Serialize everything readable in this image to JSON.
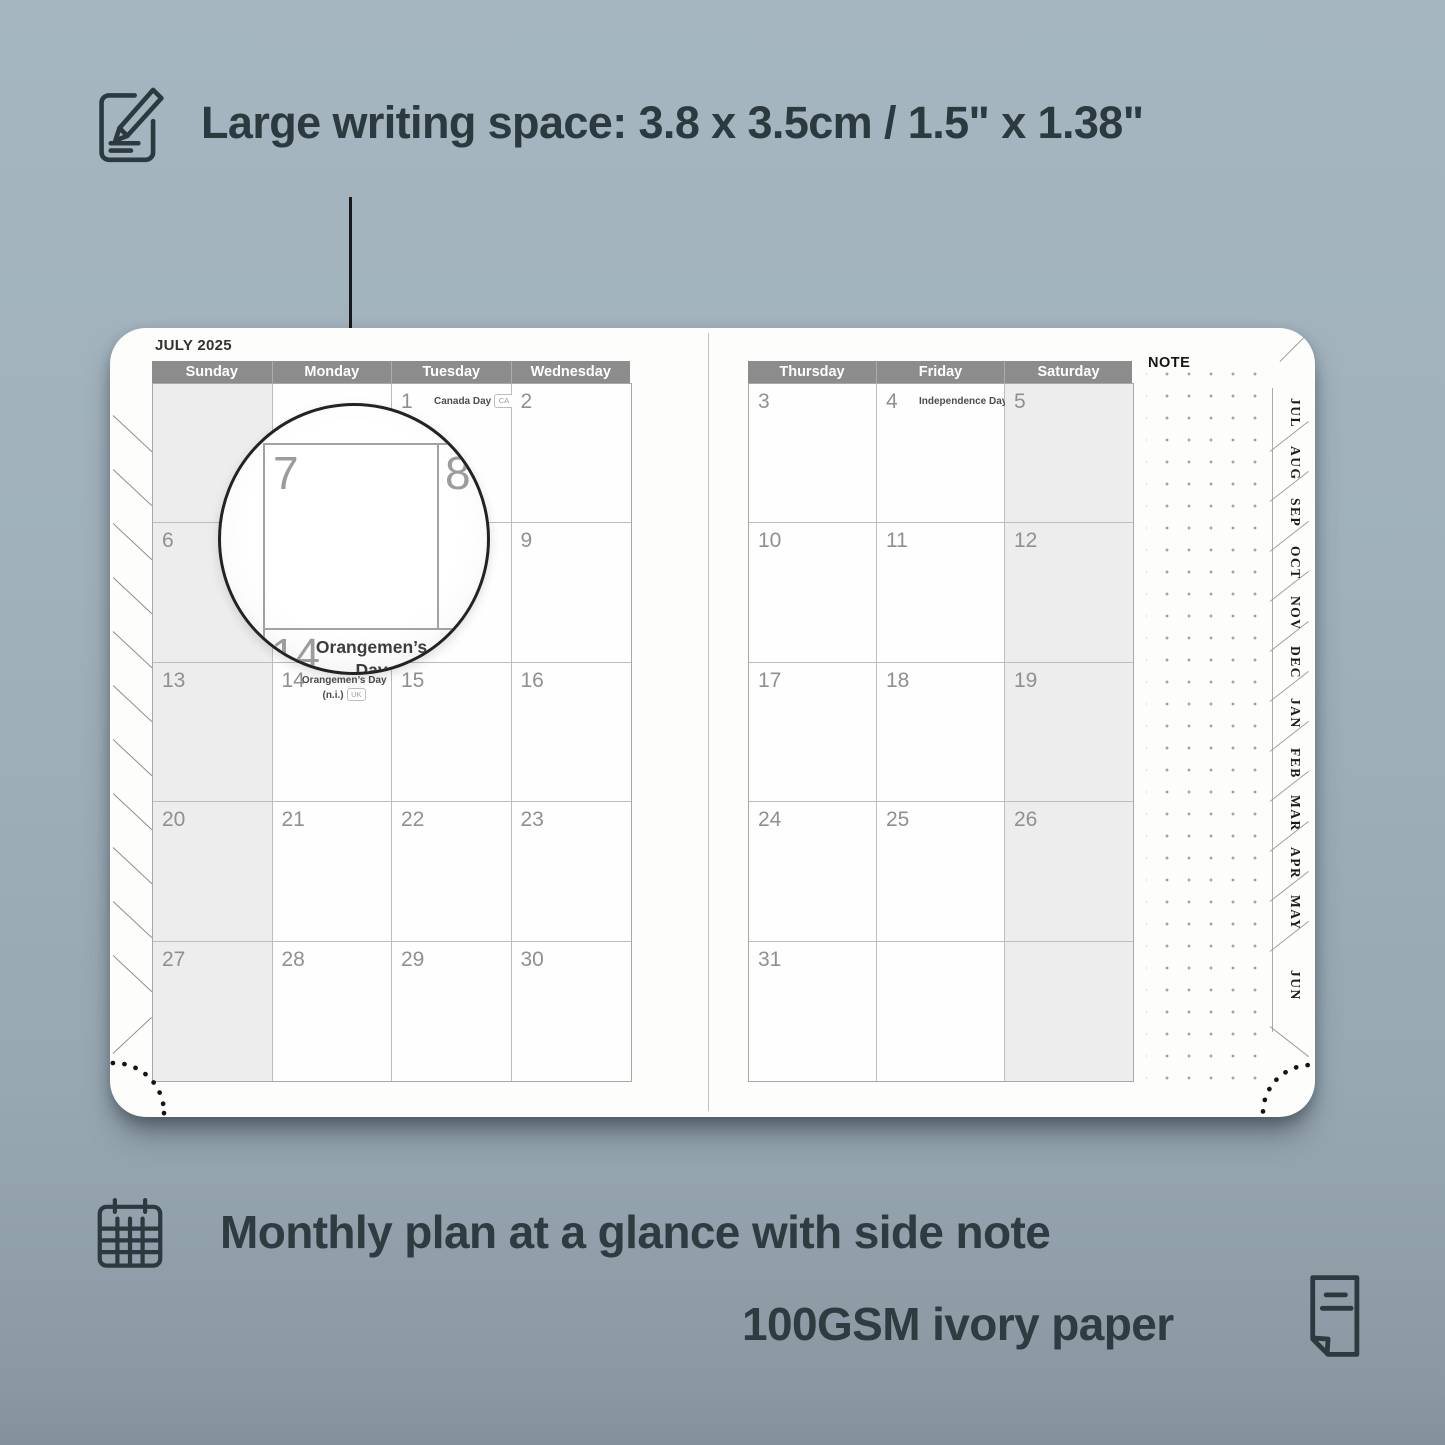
{
  "colors": {
    "background": "#9fb0ba",
    "header_bar": "#8c8c8c",
    "shaded_cell": "#ededed",
    "accent_text": "#2c3a40",
    "page": "#fdfdfc"
  },
  "headline": {
    "icon": "pencil-note-icon",
    "text": "Large writing space: 3.8 x 3.5cm / 1.5\" x 1.38\""
  },
  "planner": {
    "month_title": "JULY 2025",
    "note_label": "NOTE",
    "left_page": {
      "weekdays": [
        "Sunday",
        "Monday",
        "Tuesday",
        "Wednesday"
      ],
      "shaded_column": 0,
      "cells": [
        {
          "day": ""
        },
        {
          "day": ""
        },
        {
          "day": "1",
          "holiday": "Canada Day",
          "badge": "CA",
          "holiday_layout": "inline"
        },
        {
          "day": "2"
        },
        {
          "day": "6"
        },
        {
          "day": "7"
        },
        {
          "day": "8"
        },
        {
          "day": "9"
        },
        {
          "day": "13"
        },
        {
          "day": "14",
          "holiday": "Orangemen’s Day\n(n.i.)",
          "badge": "UK",
          "holiday_layout": "stacked"
        },
        {
          "day": "15"
        },
        {
          "day": "16"
        },
        {
          "day": "20"
        },
        {
          "day": "21"
        },
        {
          "day": "22"
        },
        {
          "day": "23"
        },
        {
          "day": "27"
        },
        {
          "day": "28"
        },
        {
          "day": "29"
        },
        {
          "day": "30"
        }
      ]
    },
    "right_page": {
      "weekdays": [
        "Thursday",
        "Friday",
        "Saturday"
      ],
      "shaded_column": 2,
      "cells": [
        {
          "day": "3"
        },
        {
          "day": "4",
          "holiday": "Independence Day",
          "badge": "US",
          "holiday_layout": "inline"
        },
        {
          "day": "5"
        },
        {
          "day": "10"
        },
        {
          "day": "11"
        },
        {
          "day": "12"
        },
        {
          "day": "17"
        },
        {
          "day": "18"
        },
        {
          "day": "19"
        },
        {
          "day": "24"
        },
        {
          "day": "25"
        },
        {
          "day": "26"
        },
        {
          "day": "31"
        },
        {
          "day": ""
        },
        {
          "day": ""
        }
      ]
    },
    "month_tabs": [
      "JUL",
      "AUG",
      "SEP",
      "OCT",
      "NOV",
      "DEC",
      "JAN",
      "FEB",
      "MAR",
      "APR",
      "MAY",
      "JUN"
    ]
  },
  "magnifier": {
    "large_day": "7",
    "adjacent_day": "8",
    "bottom_day": "14",
    "holiday_line1": "Orangemen’s Day",
    "holiday_line2": "(n.i.)",
    "badge": "UK"
  },
  "captions": [
    {
      "icon": "calendar-grid-icon",
      "text": "Monthly plan at a glance with side note"
    },
    {
      "icon": "paper-sheet-icon",
      "text": "100GSM ivory paper"
    }
  ]
}
